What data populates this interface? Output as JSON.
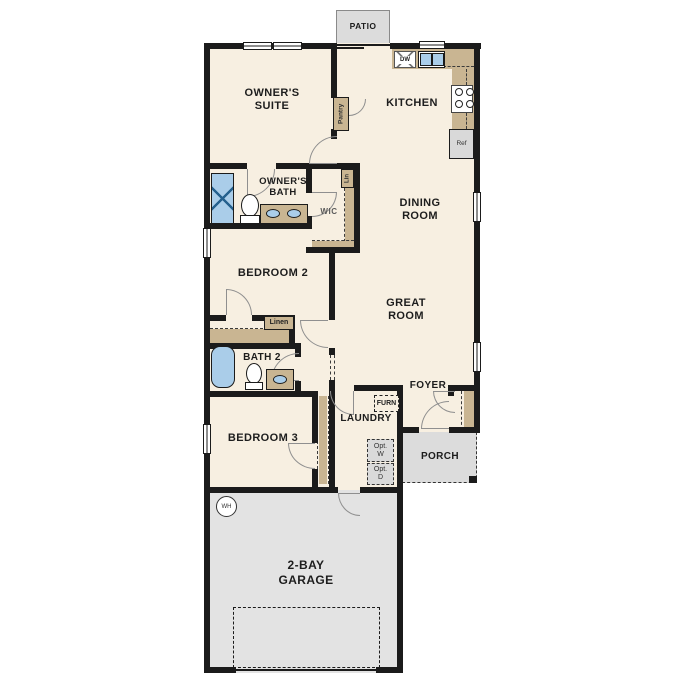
{
  "plan_title": "Single-story floor plan",
  "rooms": {
    "patio": {
      "label": "PATIO"
    },
    "owners_suite": {
      "line1": "OWNER'S",
      "line2": "SUITE"
    },
    "kitchen": {
      "label": "KITCHEN"
    },
    "owners_bath": {
      "line1": "OWNER'S",
      "line2": "BATH"
    },
    "wic": {
      "label": "WIC"
    },
    "dining": {
      "line1": "DINING",
      "line2": "ROOM"
    },
    "bedroom2": {
      "label": "BEDROOM 2"
    },
    "great": {
      "line1": "GREAT",
      "line2": "ROOM"
    },
    "bath2": {
      "label": "BATH 2"
    },
    "bedroom3": {
      "label": "BEDROOM 3"
    },
    "laundry": {
      "label": "LAUNDRY"
    },
    "foyer": {
      "label": "FOYER"
    },
    "porch": {
      "label": "PORCH"
    },
    "garage": {
      "line1": "2-BAY",
      "line2": "GARAGE"
    }
  },
  "closets": {
    "pantry": "Pantry",
    "lin": "Lin",
    "linen": "Linen"
  },
  "appliances": {
    "dishwasher": "DW",
    "refrigerator": "Ref",
    "furnace": "FURN",
    "opt_washer_line1": "Opt.",
    "opt_washer_line2": "W",
    "opt_dryer_line1": "Opt.",
    "opt_dryer_line2": "D",
    "water_heater": "WH"
  },
  "colors": {
    "floor": "#f7efe1",
    "wall": "#1b1b1b",
    "cabinet_tan": "#c9b592",
    "fixture_blue": "#aacde9",
    "concrete_gray": "#dcdcdc",
    "garage_gray": "#e3e3e3",
    "door_swing": "#8f8f8f"
  }
}
